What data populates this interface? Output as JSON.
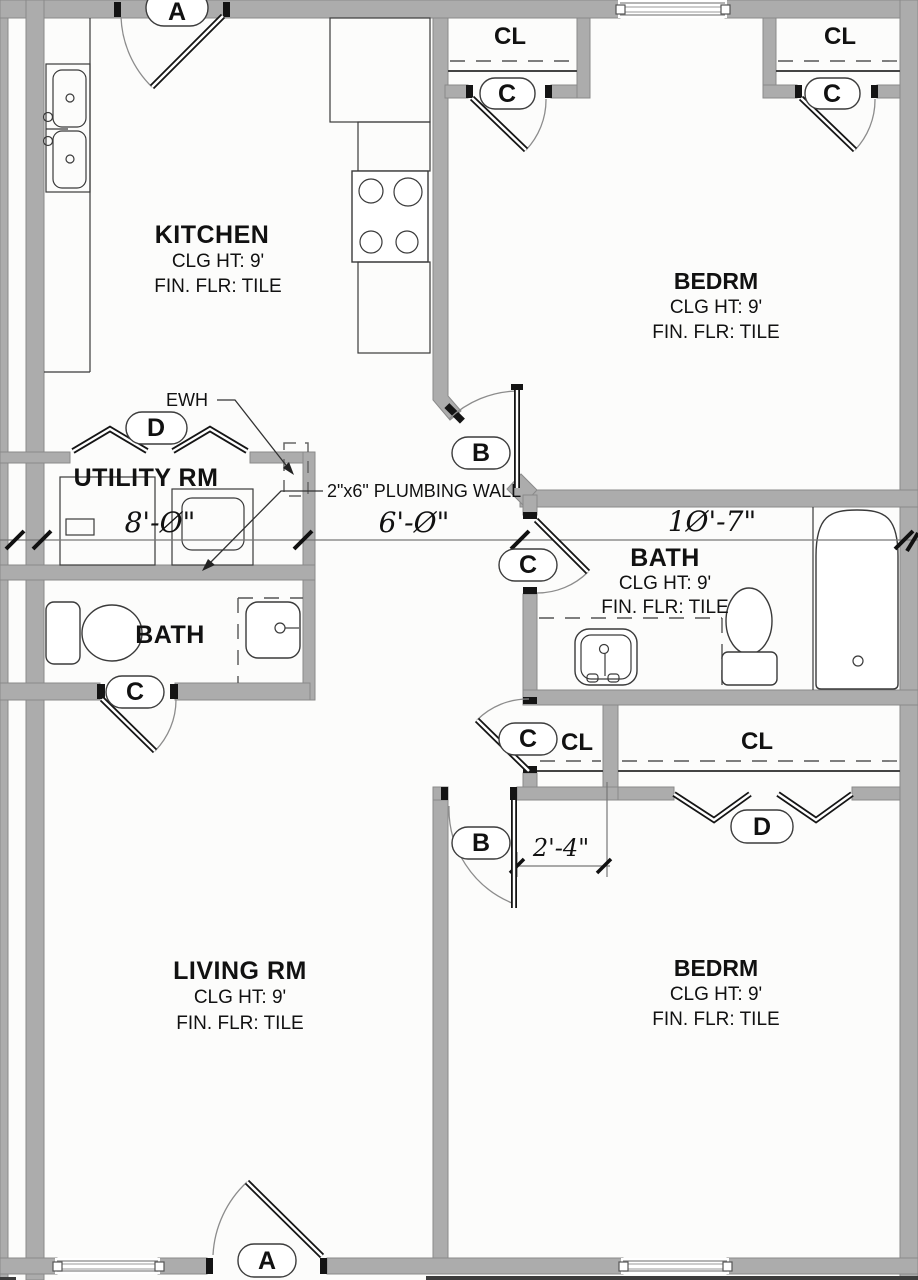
{
  "colors": {
    "wall_fill": "#acacac",
    "wall_edge": "#8a8a8a",
    "line": "#2e2e2e",
    "background": "#fcfcfb"
  },
  "rooms": {
    "kitchen": {
      "name": "KITCHEN",
      "ceiling": "CLG HT: 9'",
      "floor": "FIN. FLR: TILE"
    },
    "bedroom1": {
      "name": "BEDRM",
      "ceiling": "CLG HT: 9'",
      "floor": "FIN. FLR: TILE"
    },
    "utility": {
      "name": "UTILITY RM"
    },
    "bath1": {
      "name": "BATH"
    },
    "bath2": {
      "name": "BATH",
      "ceiling": "CLG HT: 9'",
      "floor": "FIN. FLR: TILE"
    },
    "living": {
      "name": "LIVING RM",
      "ceiling": "CLG HT: 9'",
      "floor": "FIN. FLR: TILE"
    },
    "bedroom2": {
      "name": "BEDRM",
      "ceiling": "CLG HT: 9'",
      "floor": "FIN. FLR: TILE"
    }
  },
  "closets": {
    "cl1": "CL",
    "cl2": "CL",
    "cl3": "CL",
    "cl4": "CL"
  },
  "doors": {
    "a1": "A",
    "a2": "A",
    "b1": "B",
    "b2": "B",
    "c_cl1": "C",
    "c_cl2": "C",
    "c_bath2": "C",
    "c_bath1": "C",
    "c_cl3": "C",
    "d1": "D",
    "d2": "D"
  },
  "dimensions": {
    "utility_width": "8'-Ø\"",
    "hall_width": "6'-Ø\"",
    "bath_width": "1Ø'-7\"",
    "wall_segment": "2'-4\""
  },
  "annotations": {
    "water_heater": "EWH",
    "plumbing_wall": "2\"x6\" PLUMBING WALL"
  }
}
